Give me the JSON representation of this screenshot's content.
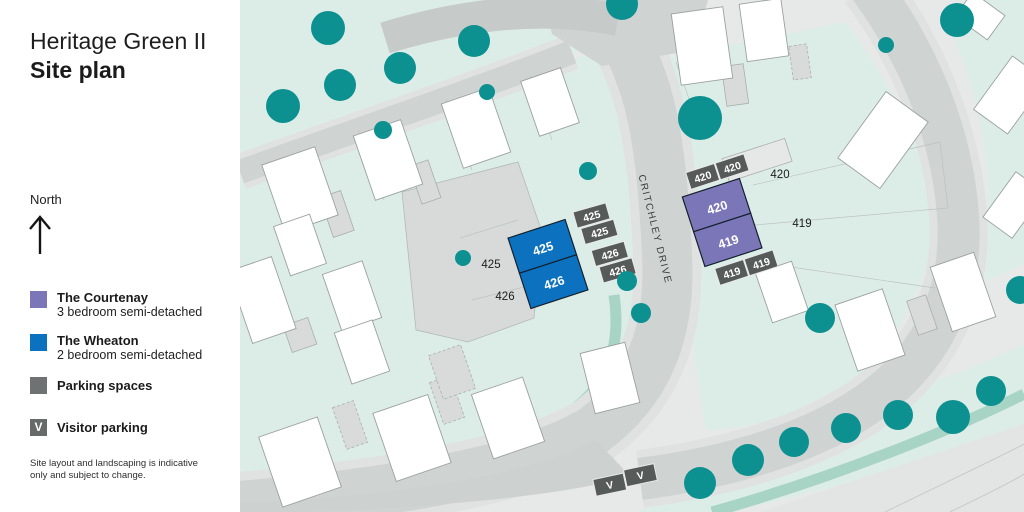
{
  "panel": {
    "title": "Heritage Green II",
    "subtitle": "Site plan",
    "north": "North",
    "legend": {
      "courtenay": {
        "name": "The Courtenay",
        "desc": "3 bedroom semi-detached",
        "color": "#7b76b7"
      },
      "wheaton": {
        "name": "The Wheaton",
        "desc": "2 bedroom semi-detached",
        "color": "#0c72bf"
      },
      "parking": {
        "name": "Parking spaces",
        "color": "#6e7272"
      },
      "visitor": {
        "name": "Visitor parking",
        "glyph": "V",
        "color": "#666b6a"
      }
    },
    "disclaimer": "Site layout and landscaping is indicative only and subject to change."
  },
  "map": {
    "street": "CRITCHLEY DRIVE",
    "buildings": {
      "wheaton": {
        "top": "425",
        "bottom": "426"
      },
      "courtenay": {
        "top": "420",
        "bottom": "419"
      }
    },
    "parcel_labels": {
      "p425": "425",
      "p426": "426",
      "p420": "420",
      "p419": "419"
    },
    "parking": {
      "wheaton": [
        "425",
        "425",
        "426",
        "426"
      ],
      "courtenay_top": [
        "420",
        "420"
      ],
      "courtenay_bottom": [
        "419",
        "419"
      ],
      "visitor": [
        "V",
        "V"
      ]
    },
    "colors": {
      "teal": "#0d9090",
      "mint": "#dcede7",
      "mint_dark": "#a8d4c5",
      "base": "#e7e9e8",
      "road": "#cfd3d2",
      "road_dark": "#c6cac9",
      "pavement": "#dfe2e1",
      "house": "#ffffff",
      "parking_gray": "#565b5a",
      "blue": "#0c72bf",
      "purple": "#7b76b7"
    }
  }
}
